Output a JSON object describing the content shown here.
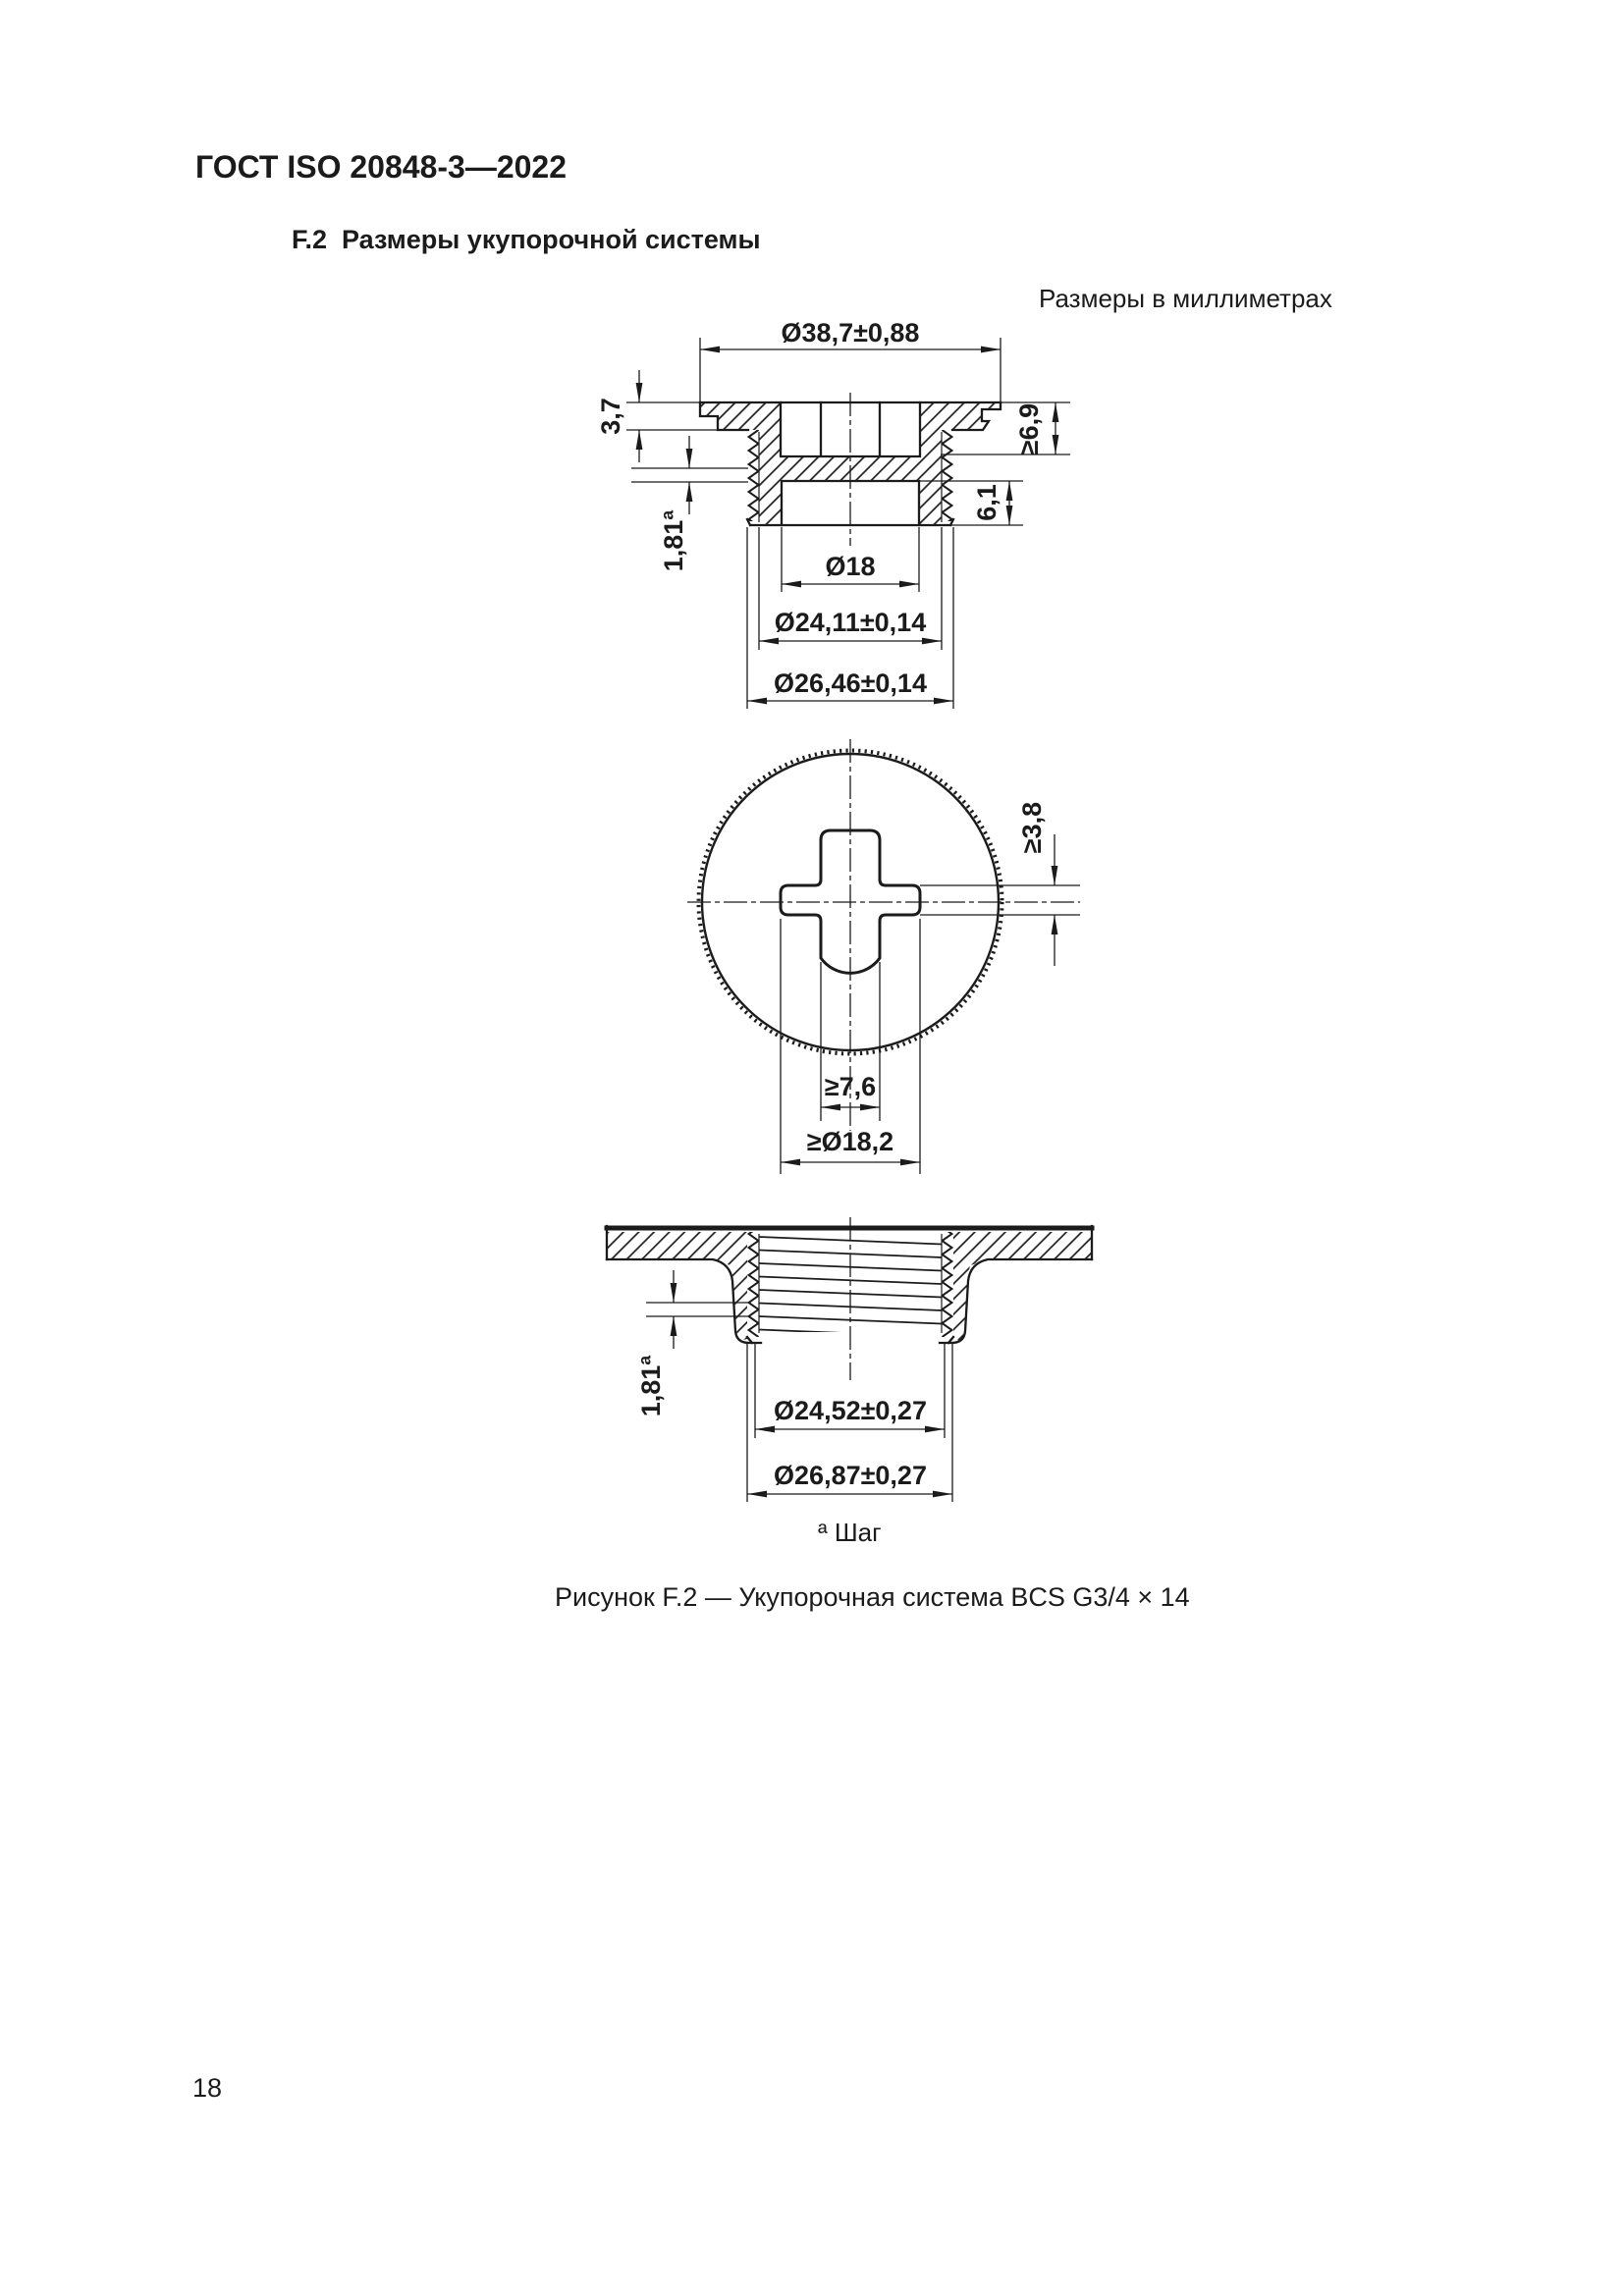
{
  "page": {
    "header": "ГОСТ ISO 20848-3—2022",
    "section_heading": "F.2  Размеры укупорочной системы",
    "units_note": "Размеры в миллиметрах",
    "footnote": "ª Шаг",
    "caption": "Рисунок F.2 — Укупорочная система BCS G3/4 × 14",
    "page_number": "18"
  },
  "d1": {
    "dia_flange": "Ø38,7±0,88",
    "flange_thk": "3,7",
    "pitch": "1,81ª",
    "h_min": "≥6,9",
    "cavity_h": "6,1",
    "dia_inner": "Ø18",
    "dia_thread_root": "Ø24,11±0,14",
    "dia_thread_crest": "Ø26,46±0,14"
  },
  "d2": {
    "slot_depth": "≥3,8",
    "slot_width": "≥7,6",
    "slot_dia": "≥Ø18,2"
  },
  "d3": {
    "pitch": "1,81ª",
    "dia_thread_inner": "Ø24,52±0,27",
    "dia_thread_outer": "Ø26,87±0,27"
  },
  "colors": {
    "line": "#1b1b1b",
    "background": "#ffffff"
  }
}
